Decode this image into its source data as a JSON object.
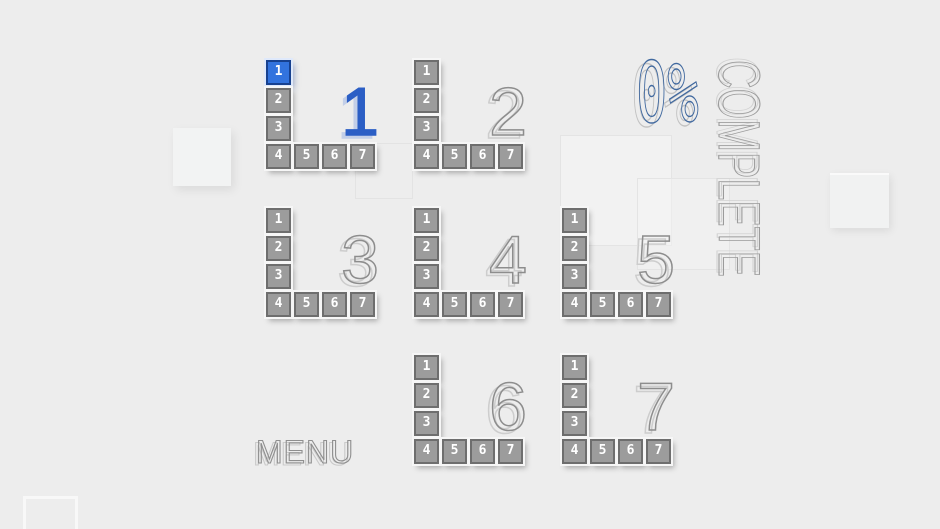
{
  "progress": {
    "percent": "0%",
    "label": "COMPLETE"
  },
  "menu_button": {
    "label": "MENU"
  },
  "levels": [
    {
      "number": "1",
      "selected": true,
      "tiles": [
        {
          "label": "1",
          "selected": true
        },
        {
          "label": "2",
          "selected": false
        },
        {
          "label": "3",
          "selected": false
        },
        {
          "label": "4",
          "selected": false
        },
        {
          "label": "5",
          "selected": false
        },
        {
          "label": "6",
          "selected": false
        },
        {
          "label": "7",
          "selected": false
        }
      ]
    },
    {
      "number": "2",
      "selected": false,
      "tiles": [
        {
          "label": "1",
          "selected": false
        },
        {
          "label": "2",
          "selected": false
        },
        {
          "label": "3",
          "selected": false
        },
        {
          "label": "4",
          "selected": false
        },
        {
          "label": "5",
          "selected": false
        },
        {
          "label": "6",
          "selected": false
        },
        {
          "label": "7",
          "selected": false
        }
      ]
    },
    {
      "number": "3",
      "selected": false,
      "tiles": [
        {
          "label": "1",
          "selected": false
        },
        {
          "label": "2",
          "selected": false
        },
        {
          "label": "3",
          "selected": false
        },
        {
          "label": "4",
          "selected": false
        },
        {
          "label": "5",
          "selected": false
        },
        {
          "label": "6",
          "selected": false
        },
        {
          "label": "7",
          "selected": false
        }
      ]
    },
    {
      "number": "4",
      "selected": false,
      "tiles": [
        {
          "label": "1",
          "selected": false
        },
        {
          "label": "2",
          "selected": false
        },
        {
          "label": "3",
          "selected": false
        },
        {
          "label": "4",
          "selected": false
        },
        {
          "label": "5",
          "selected": false
        },
        {
          "label": "6",
          "selected": false
        },
        {
          "label": "7",
          "selected": false
        }
      ]
    },
    {
      "number": "5",
      "selected": false,
      "tiles": [
        {
          "label": "1",
          "selected": false
        },
        {
          "label": "2",
          "selected": false
        },
        {
          "label": "3",
          "selected": false
        },
        {
          "label": "4",
          "selected": false
        },
        {
          "label": "5",
          "selected": false
        },
        {
          "label": "6",
          "selected": false
        },
        {
          "label": "7",
          "selected": false
        }
      ]
    },
    {
      "number": "6",
      "selected": false,
      "tiles": [
        {
          "label": "1",
          "selected": false
        },
        {
          "label": "2",
          "selected": false
        },
        {
          "label": "3",
          "selected": false
        },
        {
          "label": "4",
          "selected": false
        },
        {
          "label": "5",
          "selected": false
        },
        {
          "label": "6",
          "selected": false
        },
        {
          "label": "7",
          "selected": false
        }
      ]
    },
    {
      "number": "7",
      "selected": false,
      "tiles": [
        {
          "label": "1",
          "selected": false
        },
        {
          "label": "2",
          "selected": false
        },
        {
          "label": "3",
          "selected": false
        },
        {
          "label": "4",
          "selected": false
        },
        {
          "label": "5",
          "selected": false
        },
        {
          "label": "6",
          "selected": false
        },
        {
          "label": "7",
          "selected": false
        }
      ]
    }
  ],
  "colors": {
    "background": "#ededed",
    "accent_blue": "#3273de",
    "accent_blue_dark": "#17418f",
    "tile_gray": "#9c9c9c",
    "tile_border_gray": "#6e6e6e",
    "outline_text_gray": "#8f8f8f",
    "progress_blue": "#41699f"
  }
}
